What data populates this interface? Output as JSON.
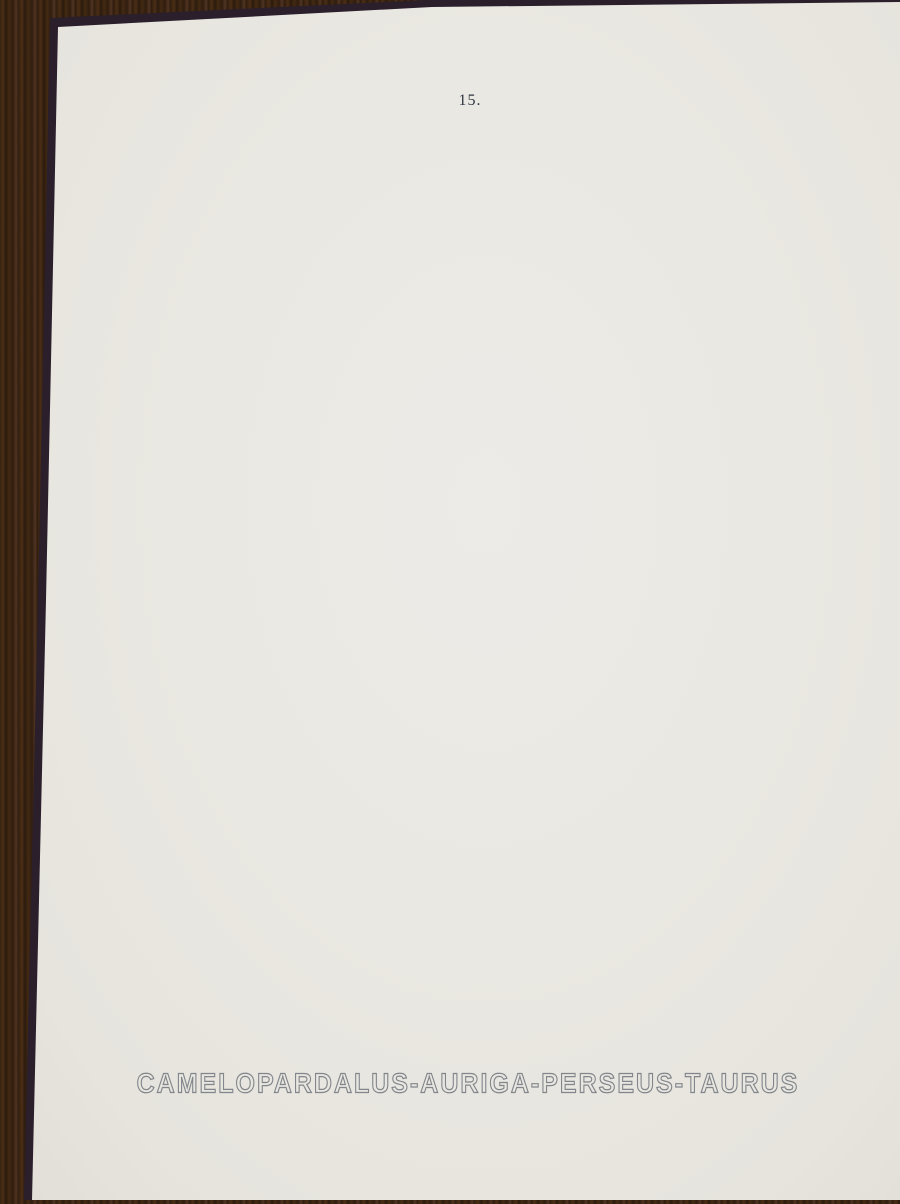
{
  "page": {
    "number": "15."
  },
  "title": "CAMELOPARDALUS-AURIGA-PERSEUS-TAURUS",
  "map": {
    "hour_labels": [
      "6ʰ",
      "5ʰ40ᵐ",
      "5ʰ20ᵐ",
      "5ʰ",
      "4ʰ40ᵐ",
      "4ʰ20ᵐ",
      "4ʰ"
    ],
    "declination_labels": [
      "60",
      "55",
      "50",
      "45",
      "40",
      "35",
      "30",
      "25",
      "20"
    ],
    "annotations": {
      "top_left": "100pr. +55ˢ8 −1′2",
      "top_right": "100pr. +52ˢ5 +16′7",
      "mid_left_line1": "100pr.",
      "mid_left_line2": "+41ˢ5 −1′2",
      "mid_right_line1": "100pr.",
      "mid_right_line2": "+40ˢ4 +16′7",
      "bottom_left": "100pr. +35ˢ6 −1′2",
      "bottom_right": "100pr. +34ˢ9 +16′7"
    },
    "magnitude_scale": {
      "labels": [
        "1",
        "2",
        "3",
        "4",
        "5",
        "6",
        "7",
        "8",
        "9.5"
      ]
    },
    "colors": {
      "paper": "#eae8e2",
      "wood": "#38220f",
      "border": "#1b2130",
      "grid": "#5f6a76",
      "band": "#3c4654",
      "ink": "#333d4c",
      "star": "#232c3e"
    },
    "stars": {
      "seed": 42,
      "count": 1500,
      "bright": [
        [
          463,
          504,
          4.2
        ],
        [
          296,
          511,
          2.6
        ],
        [
          519,
          599,
          3.0
        ],
        [
          546,
          776,
          2.8
        ],
        [
          437,
          770,
          2.4
        ],
        [
          676,
          736,
          2.8
        ],
        [
          571,
          911,
          2.6
        ],
        [
          365,
          223,
          2.2
        ],
        [
          560,
          980,
          2.6
        ],
        [
          430,
          1000,
          2.4
        ],
        [
          232,
          830,
          2.4
        ],
        [
          610,
          450,
          2.2
        ],
        [
          520,
          300,
          2.0
        ],
        [
          700,
          880,
          2.6
        ],
        [
          340,
          640,
          2.2
        ],
        [
          245,
          690,
          2.0
        ],
        [
          640,
          960,
          2.2
        ],
        [
          490,
          870,
          2.0
        ]
      ]
    }
  }
}
